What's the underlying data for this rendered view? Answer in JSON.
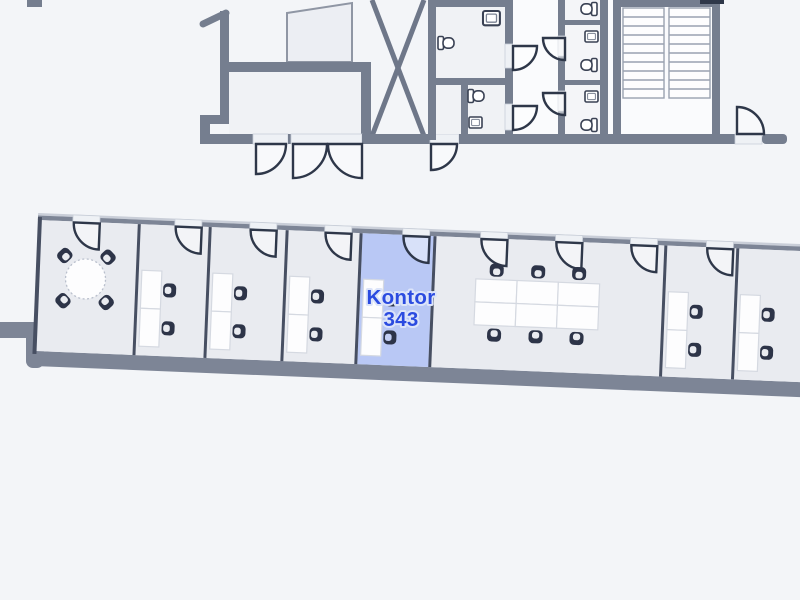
{
  "map": {
    "type": "indoor-floor-plan",
    "highlighted_room": {
      "name": "Kontor",
      "number": "343",
      "full_label": "Kontor 343"
    },
    "colors": {
      "background": "#f3f5f8",
      "office_fill": "#e9ebf0",
      "top_room_fill": "#f0f2f5",
      "corridor_fill": "#fafbfd",
      "wall_thick": "#7d8596",
      "wall_structure": "#757e8f",
      "wall_divider": "#474f62",
      "door_stroke": "#2e3749",
      "chair": "#2d3448",
      "desk_fill": "#fdfdfe",
      "highlight_fill": "#b9c8f5",
      "highlight_text": "#2b4be0"
    },
    "office_band_rooms": [
      {
        "id": "meeting-room",
        "furniture": "round table with 4 chairs",
        "doors": 1
      },
      {
        "id": "office-1",
        "furniture": "2 desks, 2 chairs",
        "doors": 1
      },
      {
        "id": "office-2",
        "furniture": "2 desks, 2 chairs",
        "doors": 1
      },
      {
        "id": "office-3",
        "furniture": "2 desks, 2 chairs",
        "doors": 1
      },
      {
        "id": "office-kontor-343",
        "label": "Kontor 343",
        "highlighted": true,
        "furniture": "2 desks, 2 chairs",
        "doors": 1
      },
      {
        "id": "open-office",
        "furniture": "6 desks, 6 chairs",
        "doors": 3
      },
      {
        "id": "office-4",
        "furniture": "2 desks, 2 chairs",
        "doors": 1
      },
      {
        "id": "office-5",
        "furniture": "2 desks, 2 chairs",
        "doors": 1
      }
    ],
    "top_structures": [
      "upper-room-block",
      "x-braced-shaft",
      "wc-rooms",
      "corridor",
      "toilet-stalls",
      "staircase"
    ]
  }
}
